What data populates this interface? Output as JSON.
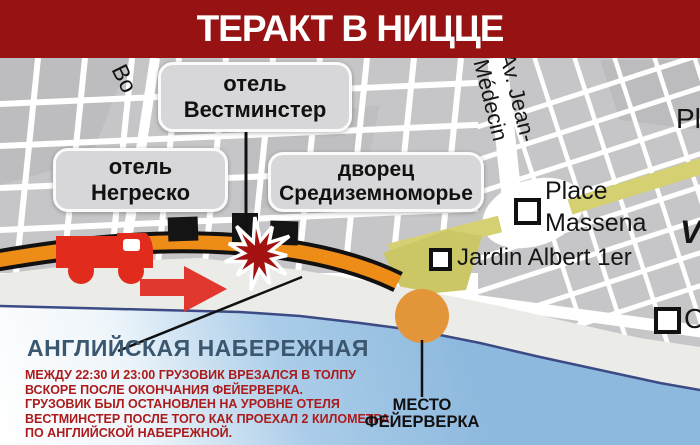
{
  "header": {
    "title": "ТЕРАКТ В НИЦЦЕ"
  },
  "map": {
    "callout_boxes": {
      "hotel_westminster": {
        "line1": "отель",
        "line2": "Вестминстер"
      },
      "hotel_negresco": {
        "line1": "отель",
        "line2": "Негреско"
      },
      "palace_mediterranee": {
        "line1": "дворец",
        "line2": "Средиземноморье"
      }
    },
    "street_labels": {
      "av_jean_medecin": "Av. Jean-\nMédecin",
      "boulevard_partial": "Bo",
      "place_partial": "Pl",
      "vieille_ville_partial": "V",
      "cours_partial": "C",
      "place_massena": {
        "line1": "Place",
        "line2": "Massena"
      },
      "jardin_albert": "Jardin Albert 1er"
    },
    "icons": {
      "truck": "truck-icon",
      "explosion": "explosion-icon",
      "arrow": "direction-arrow-icon",
      "fireworks_spot": "fireworks-circle"
    }
  },
  "promenade": {
    "title": "АНГЛИЙСКАЯ НАБЕРЕЖНАЯ",
    "description": "МЕЖДУ 22:30 И 23:00 ГРУЗОВИК ВРЕЗАЛСЯ В ТОЛПУ\nВСКОРЕ ПОСЛЕ ОКОНЧАНИЯ ФЕЙЕРВЕРКА.\nГРУЗОВИК БЫЛ ОСТАНОВЛЕН НА УРОВНЕ ОТЕЛЯ\nВЕСТМИНСТЕР ПОСЛЕ ТОГО КАК ПРОЕХАЛ 2 КИЛОМЕТРА\nПО АНГЛИЙСКОЙ НАБЕРЕЖНОЙ."
  },
  "fireworks": {
    "label": "МЕСТО\nФЕЙЕРВЕРКА"
  },
  "colors": {
    "header_bg": "#971313",
    "road_orange": "#ee8c18",
    "sea_blue": "#8eb9de",
    "block_gray": "#c6c6c8",
    "yellow_street": "#d5d172",
    "beach": "#ebebe8",
    "explosion_red": "#a31111",
    "truck_red": "#e12b1d",
    "arrow_red": "#e1372e",
    "fireworks_orange": "#e3953a",
    "promenade_text": "#3b566f",
    "description_text": "#ac1b1b",
    "marker_black": "#141414"
  }
}
